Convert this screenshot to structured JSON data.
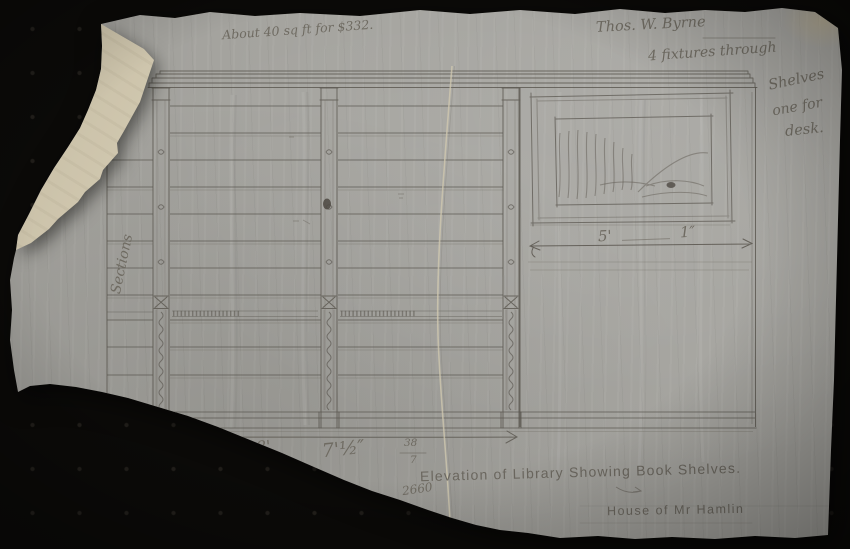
{
  "artifact": {
    "kind": "pencil architectural drawing on tracing paper",
    "title": "Elevation of Library Showing Book Shelves.",
    "project": "House of Mr Hamlin",
    "drawing_number": "2660",
    "sheet_fraction_numerator": "38",
    "sheet_fraction_denominator": "7"
  },
  "annotations": {
    "area_note": "About 40 sq ft for $332.",
    "client_name": "Thos. W. Byrne",
    "fixtures_line1": "4 fixtures through",
    "fixtures_line2": "Shelves",
    "fixtures_line3": "one for",
    "fixtures_line4": "desk.",
    "side_label": "Sections"
  },
  "dimensions": {
    "picture_width_feet": "5'",
    "picture_width_inches": "1″",
    "bottom_left": "8'",
    "bottom_right": "7'½″"
  },
  "colors": {
    "background": "#0b0a08",
    "paper": "#a2a19c",
    "folded_corner": "#d8cfb7",
    "pencil": "#59554e"
  }
}
